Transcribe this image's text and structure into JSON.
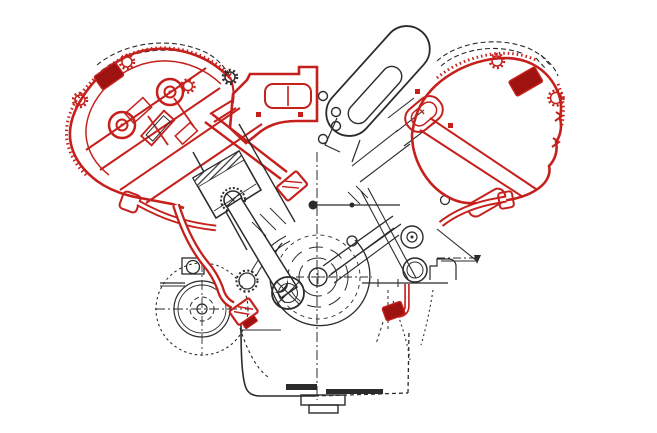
{
  "figure": {
    "kind": "technical-cutaway-illustration",
    "subject": "v-engine-cross-section",
    "visible_text": ""
  },
  "colors": {
    "background": "#ffffff",
    "line_ink": "#2b2b2b",
    "highlight_red": "#c5201c",
    "highlight_red_dark": "#9e1210"
  },
  "components": [
    "hood-dashed-outline",
    "left-cam-cover",
    "left-camshaft-bearings",
    "valve-springs",
    "spark-plug",
    "intake-runner",
    "pushrod-tube",
    "piston",
    "connecting-rod",
    "big-end-bearing",
    "intake-plenum-duct",
    "right-cam-cover",
    "ignition-coil-block",
    "inspection-plate",
    "breather-pipe",
    "crankshaft",
    "front-damper-pulley",
    "idler-pulley",
    "accessory-pulley",
    "drive-belt",
    "engine-mount-bracket",
    "oil-pan",
    "drain-plug",
    "oil-line-left",
    "oil-union-left",
    "oil-line-right",
    "exhaust-header-left",
    "timing-sprocket",
    "centerlines"
  ]
}
